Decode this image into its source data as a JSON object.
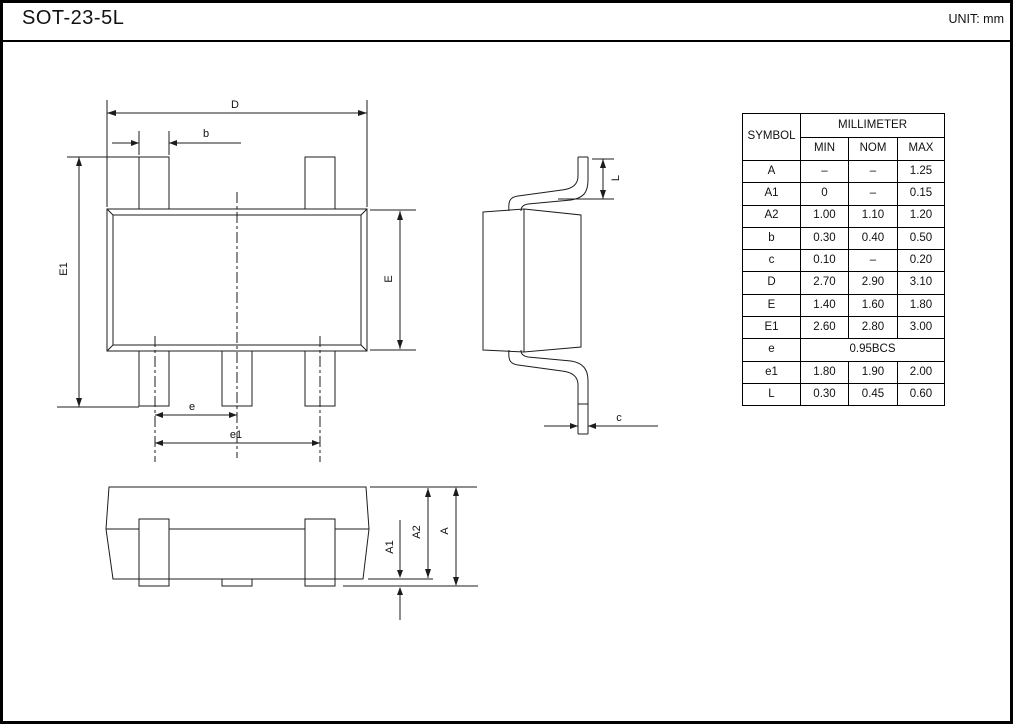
{
  "header": {
    "title": "SOT-23-5L",
    "unit": "UNIT: mm"
  },
  "dim_table": {
    "symbol_header": "SYMBOL",
    "unit_header": "MILLIMETER",
    "cols": [
      "MIN",
      "NOM",
      "MAX"
    ],
    "rows": [
      {
        "symbol": "A",
        "min": "–",
        "nom": "–",
        "max": "1.25"
      },
      {
        "symbol": "A1",
        "min": "0",
        "nom": "–",
        "max": "0.15"
      },
      {
        "symbol": "A2",
        "min": "1.00",
        "nom": "1.10",
        "max": "1.20"
      },
      {
        "symbol": "b",
        "min": "0.30",
        "nom": "0.40",
        "max": "0.50"
      },
      {
        "symbol": "c",
        "min": "0.10",
        "nom": "–",
        "max": "0.20"
      },
      {
        "symbol": "D",
        "min": "2.70",
        "nom": "2.90",
        "max": "3.10"
      },
      {
        "symbol": "E",
        "min": "1.40",
        "nom": "1.60",
        "max": "1.80"
      },
      {
        "symbol": "E1",
        "min": "2.60",
        "nom": "2.80",
        "max": "3.00"
      },
      {
        "symbol": "e",
        "value": "0.95BCS"
      },
      {
        "symbol": "e1",
        "min": "1.80",
        "nom": "1.90",
        "max": "2.00"
      },
      {
        "symbol": "L",
        "min": "0.30",
        "nom": "0.45",
        "max": "0.60"
      }
    ]
  },
  "labels": {
    "D": "D",
    "b": "b",
    "E1": "E1",
    "E": "E",
    "e": "e",
    "e1": "e1",
    "L": "L",
    "c": "c",
    "A": "A",
    "A1": "A1",
    "A2": "A2"
  }
}
